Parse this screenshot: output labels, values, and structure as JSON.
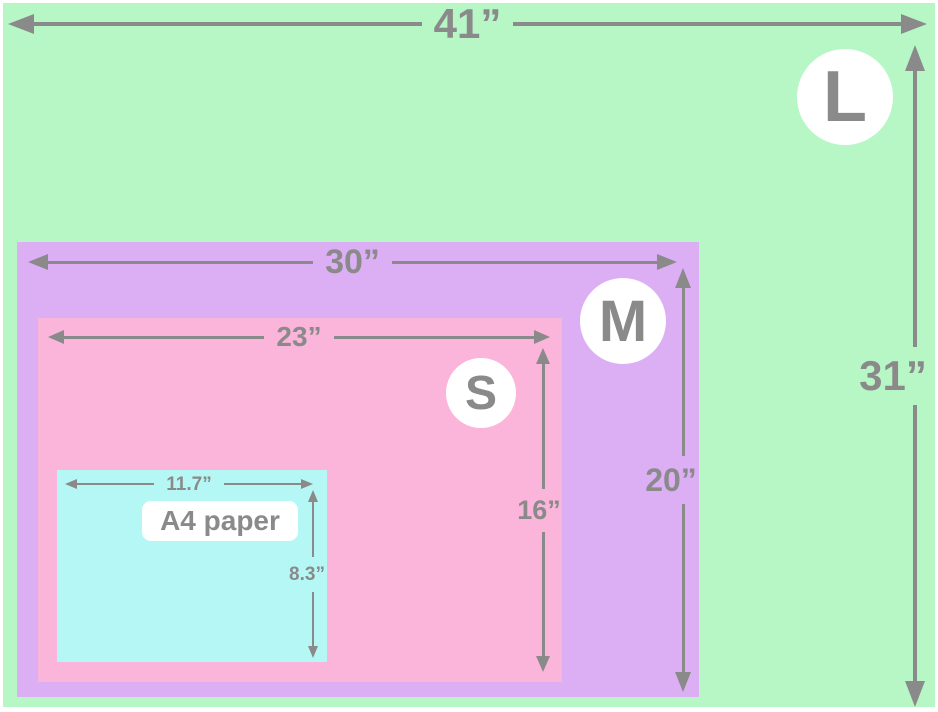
{
  "colors": {
    "green": "#b7f7c5",
    "purple": "#dcaff5",
    "pink": "#fcb5da",
    "cyan": "#b5f7f5",
    "gray": "#8a8a8a",
    "white": "#ffffff"
  },
  "sizes": {
    "l": {
      "badge": "L",
      "width": "41”",
      "height": "31”",
      "color": "#b7f7c5"
    },
    "m": {
      "badge": "M",
      "width": "30”",
      "height": "20”",
      "color": "#dcaff5"
    },
    "s": {
      "badge": "S",
      "width": "23”",
      "height": "16”",
      "color": "#fcb5da"
    },
    "a4": {
      "label": "A4 paper",
      "width": "11.7”",
      "height": "8.3”",
      "color": "#b5f7f5"
    }
  }
}
